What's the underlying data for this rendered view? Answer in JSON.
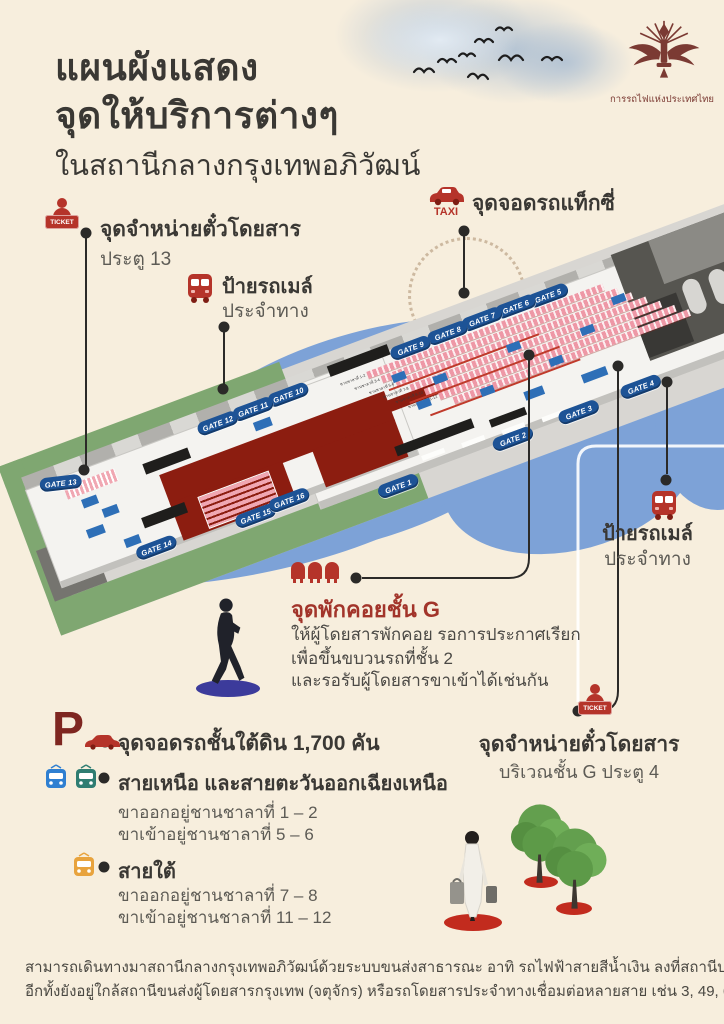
{
  "title": {
    "line1": "แผนผังแสดง",
    "line2": "จุดให้บริการต่างๆ",
    "line3": "ในสถานีกลางกรุงเทพอภิวัฒน์"
  },
  "logo": {
    "caption": "การรถไฟแห่งประเทศไทย"
  },
  "callouts": {
    "ticket_left": {
      "badge": "TICKET",
      "title": "จุดจำหน่ายตั๋วโดยสาร",
      "subtitle": "ประตู 13"
    },
    "bus_left": {
      "title": "ป้ายรถเมล์",
      "subtitle": "ประจำทาง"
    },
    "taxi": {
      "badge": "TAXI",
      "title": "จุดจอดรถแท็กซี่"
    },
    "bus_right": {
      "title": "ป้ายรถเมล์",
      "subtitle": "ประจำทาง"
    },
    "waiting": {
      "title": "จุดพักคอยชั้น G",
      "desc1": "ให้ผู้โดยสารพักคอย รอการประกาศเรียก",
      "desc2": "เพื่อขึ้นขบวนรถที่ชั้น 2",
      "desc3": "และรอรับผู้โดยสารขาเข้าได้เช่นกัน"
    },
    "ticket_right": {
      "badge": "TICKET",
      "title": "จุดจำหน่ายตั๋วโดยสาร",
      "subtitle": "บริเวณชั้น G ประตู 4"
    }
  },
  "legend": {
    "parking": {
      "symbol": "P",
      "label": "จุดจอดรถชั้นใต้ดิน 1,700 คัน"
    },
    "north_northeast": {
      "label": "สายเหนือ และสายตะวันออกเฉียงเหนือ",
      "depart": "ขาออกอยู่ชานชาลาที่ 1 – 2",
      "arrive": "ขาเข้าอยู่ชานชาลาที่ 5 – 6"
    },
    "south": {
      "label": "สายใต้",
      "depart": "ขาออกอยู่ชานชาลาที่ 7 – 8",
      "arrive": "ขาเข้าอยู่ชานชาลาที่ 11 – 12"
    }
  },
  "map": {
    "gates": [
      "GATE 1",
      "GATE 2",
      "GATE 3",
      "GATE 4",
      "GATE 5",
      "GATE 6",
      "GATE 7",
      "GATE 8",
      "GATE 9",
      "GATE 10",
      "GATE 11",
      "GATE 12",
      "GATE 13",
      "GATE 14",
      "GATE 15",
      "GATE 16"
    ],
    "platform_labels": [
      "ชานชาลาที่ 1-2",
      "ชานชาลาที่ 3-4",
      "ชานชาลาที่ 5-6",
      "ชานชาลาที่ 7-8",
      "ชานชาลาที่ 9-10",
      "ชานชาลาที่ 11-12"
    ]
  },
  "footer": {
    "line1": "สามารถเดินทางมาสถานีกลางกรุงเทพอภิวัฒน์ด้วยระบบขนส่งสาธารณะ อาทิ รถไฟฟ้าสายสีน้ำเงิน ลงที่สถานีบางซื่อ",
    "line2": "อีกทั้งยังอยู่ใกล้สถานีขนส่งผู้โดยสารกรุงเทพ (จตุจักร) หรือรถโดยสารประจำทางเชื่อมต่อหลายสาย เช่น 3, 49, 67"
  },
  "colors": {
    "accent_red": "#b5342a",
    "logo_maroon": "#7b3a33",
    "gate_blue": "#1d5396",
    "blob_blue": "#7da2d7",
    "grass_green": "#7fa771",
    "map_maroon": "#8c1d10",
    "line_dark": "#2b2a28"
  }
}
